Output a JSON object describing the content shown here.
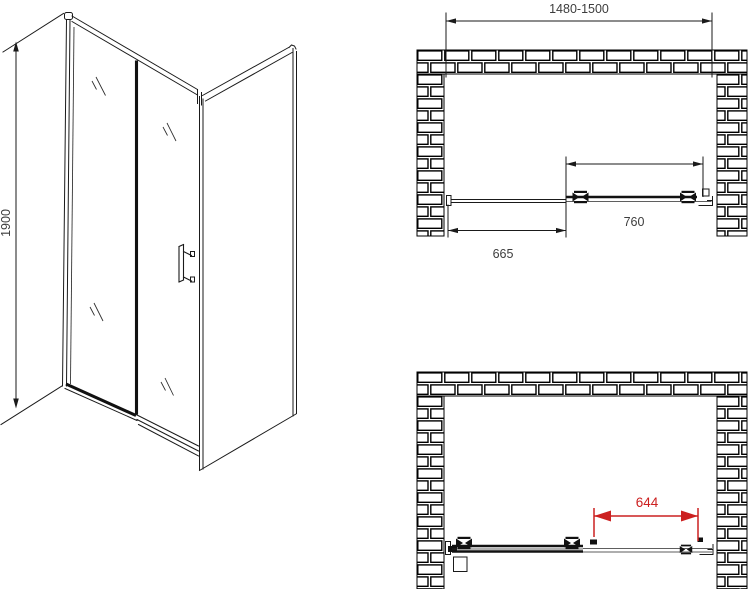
{
  "drawing": {
    "views": {
      "isometric_label": "shower-sliding-door-isometric-view",
      "plan_closed_label": "plan-view-door-closed",
      "plan_open_label": "plan-view-door-open"
    },
    "dimensions": {
      "height": "1900",
      "width_range": "1480-1500",
      "door_panel_width": "760",
      "fixed_section_width": "665",
      "open_passage_width": "644"
    },
    "colors": {
      "line": "#1a1a1a",
      "dimension_text": "#3d3d3d",
      "accent_red": "#cc2020",
      "background": "#ffffff"
    }
  }
}
